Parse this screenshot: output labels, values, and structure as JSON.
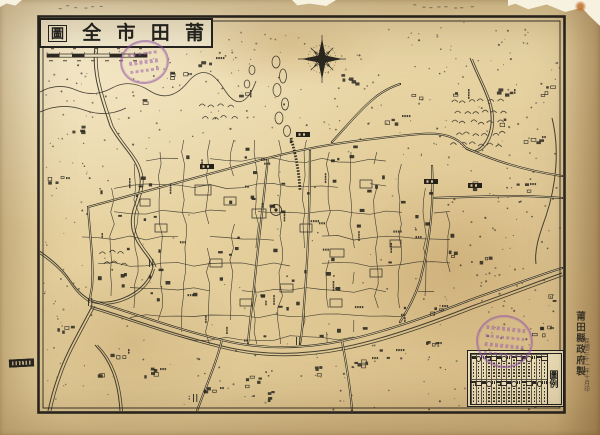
{
  "title": {
    "reading_right_to_left": "莆田市全圖",
    "characters": [
      "圖",
      "全",
      "市",
      "田",
      "莆"
    ]
  },
  "legend": {
    "title": "圖例",
    "columns": 15,
    "rows": 2
  },
  "colophon": {
    "publisher": "莆田縣政府製",
    "date": "民國三十一年十月印"
  },
  "icons": {
    "compass": "eight-point-star-compass-rose",
    "seals": "circular-purple-ink-stamps"
  },
  "seals": [
    {
      "position": "top-left"
    },
    {
      "position": "bottom-right"
    }
  ],
  "colors": {
    "paper": "#e8d5a4",
    "paper_light": "#f3e9cc",
    "ink": "#2c2922",
    "river": "#454031",
    "seal": "#8e55a6",
    "stain": "#b98f52",
    "tear": "#f7f1e0"
  }
}
